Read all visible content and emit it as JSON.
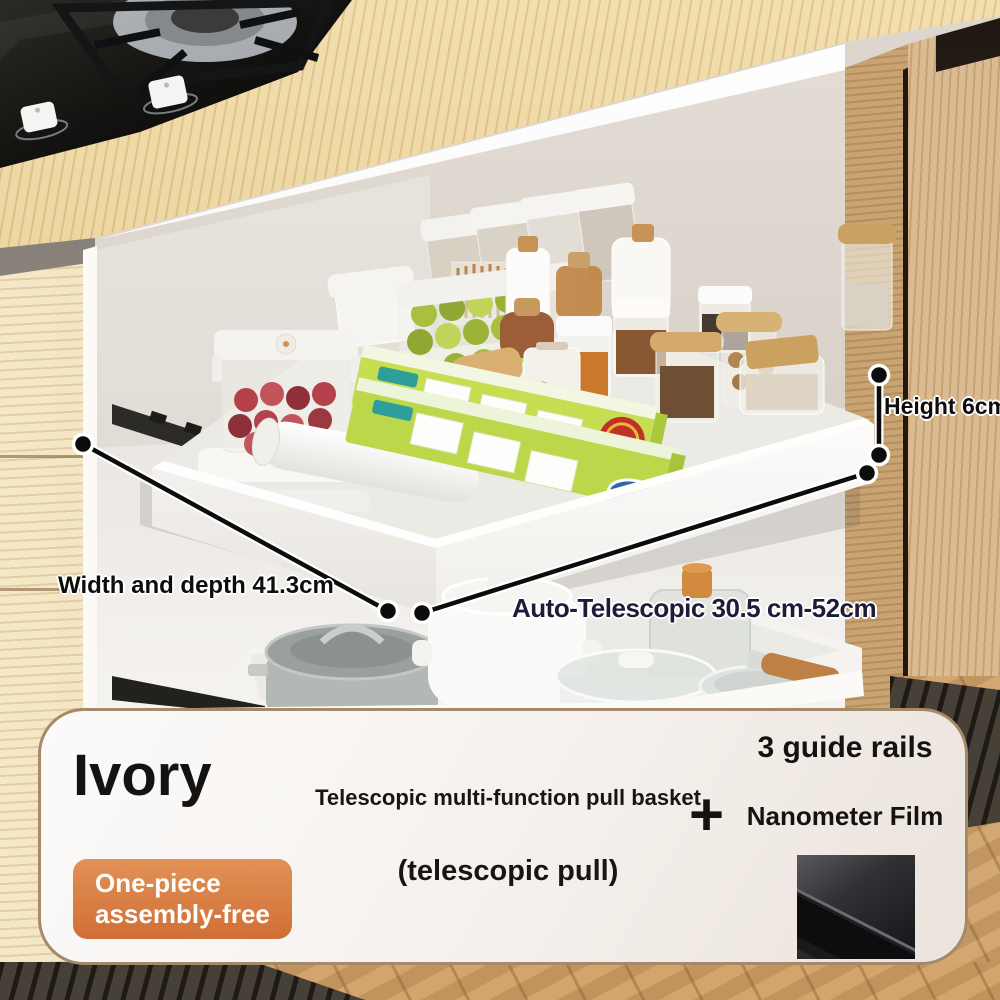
{
  "annotations": {
    "height": "Height 6cm",
    "width_depth": "Width and depth 41.3cm",
    "telescopic_range": "Auto-Telescopic 30.5 cm-52cm"
  },
  "drawer": {
    "flour_jar_label": "flo"
  },
  "info_panel": {
    "color_name": "Ivory",
    "badge": {
      "line1": "One-piece",
      "line2": "assembly-free",
      "color": "#d3753c"
    },
    "title": "Telescopic multi-function pull basket",
    "subtitle": "(telescopic pull)",
    "plus": "+",
    "feature_1": "3 guide rails",
    "feature_2": "Nanometer Film"
  },
  "colors": {
    "panel_border": "#a58a6a",
    "annotation_ink": "#0d0d0d",
    "telescopic_ink": "#1d1d3a",
    "wood_counter": "#e9cf97",
    "wood_door": "#d6b282"
  }
}
